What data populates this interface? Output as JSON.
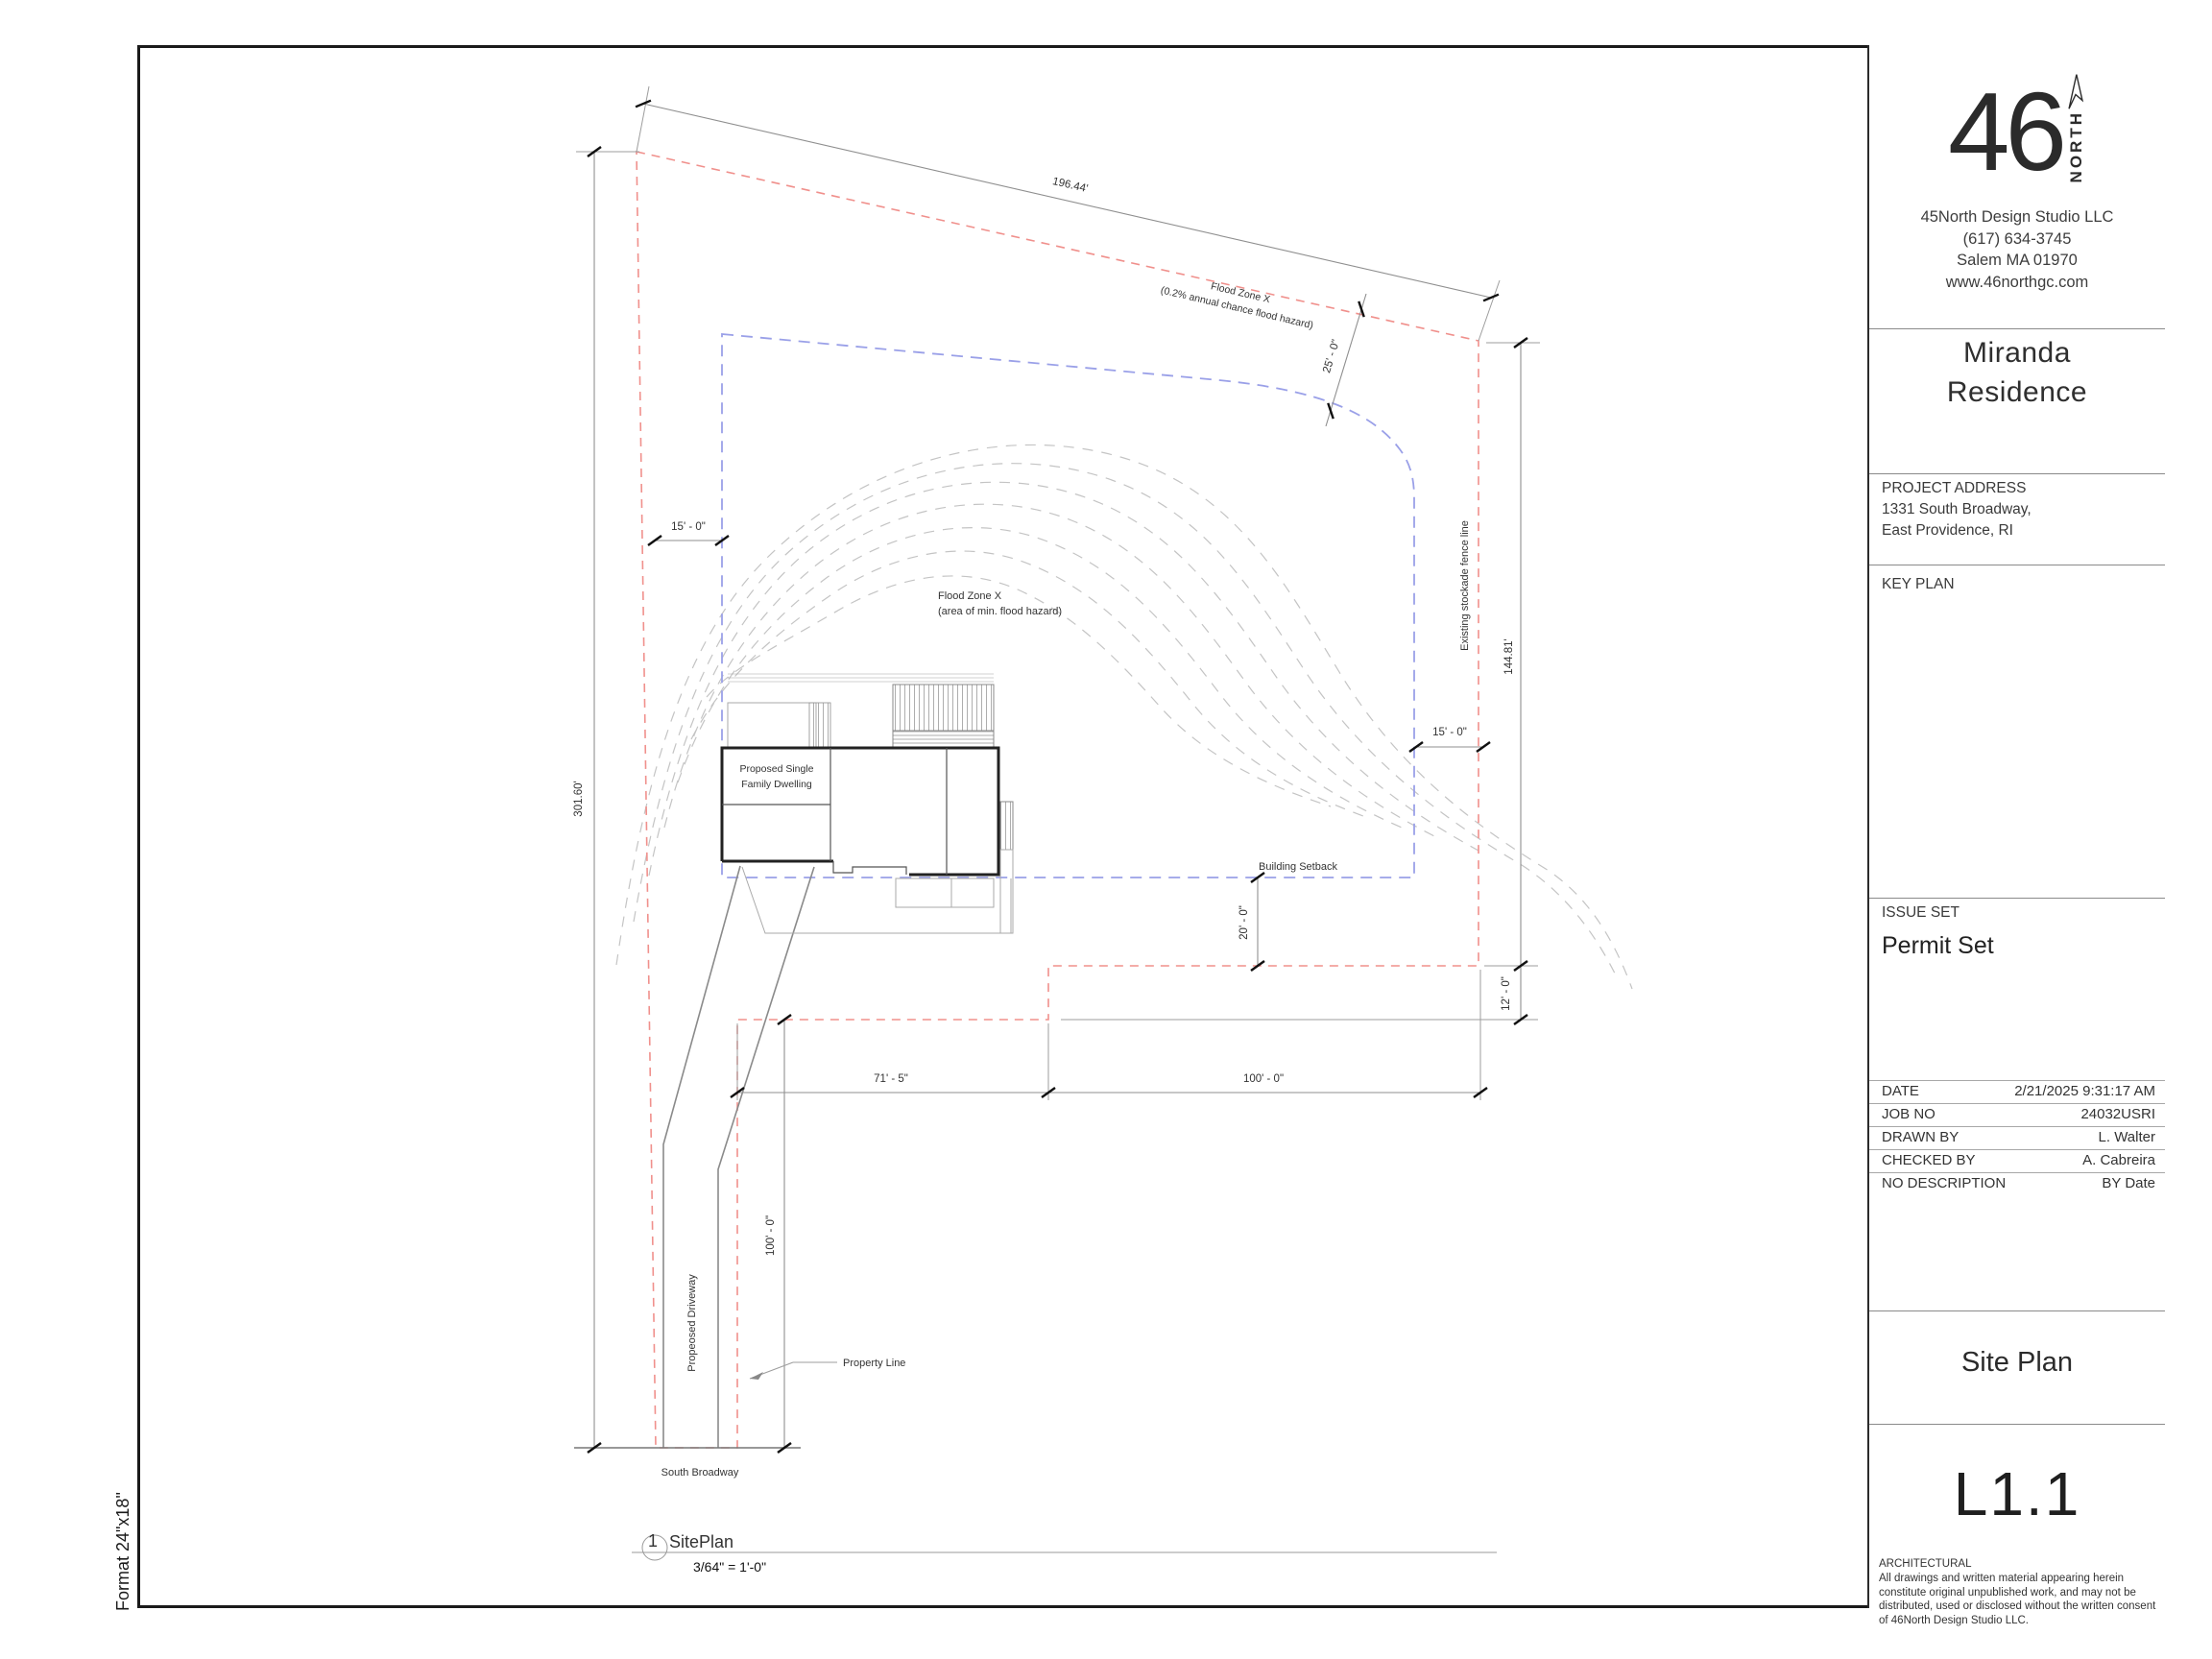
{
  "sheet": {
    "format": "Format 24\"x18\"",
    "border_color": "#1a1a1a"
  },
  "viewport_title": {
    "number": "1",
    "name": "SitePlan",
    "scale": "3/64\" = 1'-0\""
  },
  "title_block": {
    "logo": {
      "number": "46",
      "north": "NORTH"
    },
    "firm": {
      "name": "45North Design Studio LLC",
      "phone": "(617) 634-3745",
      "city": "Salem MA 01970",
      "website": "www.46northgc.com"
    },
    "project_name_1": "Miranda",
    "project_name_2": "Residence",
    "address_label": "PROJECT ADDRESS",
    "address_1": "1331 South Broadway,",
    "address_2": "East Providence, RI",
    "key_plan_label": "KEY PLAN",
    "issue_label": "ISSUE SET",
    "issue_value": "Permit Set",
    "info_rows": [
      {
        "label": "DATE",
        "value": "2/21/2025 9:31:17 AM"
      },
      {
        "label": "JOB NO",
        "value": "24032USRI"
      },
      {
        "label": "DRAWN BY",
        "value": "L. Walter"
      },
      {
        "label": "CHECKED BY",
        "value": "A. Cabreira"
      },
      {
        "label": "NO DESCRIPTION",
        "value": "BY Date"
      }
    ],
    "sheet_name": "Site Plan",
    "sheet_number": "L1.1",
    "discipline": "ARCHITECTURAL",
    "disclaimer": "All drawings and written material appearing herein constitute original unpublished work, and may not be distributed, used or disclosed without the written consent of 46North Design Studio LLC."
  },
  "plan": {
    "dims": {
      "top": "196.44'",
      "left": "301.60'",
      "right": "144.81'",
      "flood_offset": "25' - 0\"",
      "setback_left": "15' - 0\"",
      "setback_right": "15' - 0\"",
      "rear_setback": "20' - 0\"",
      "strip": "12' - 0\"",
      "front_left": "71' - 5\"",
      "front_right": "100' - 0\"",
      "driveway": "100' - 0\""
    },
    "labels": {
      "flood1_line1": "Flood Zone X",
      "flood1_line2": "(0.2% annual chance flood hazard)",
      "flood2_line1": "Flood Zone X",
      "flood2_line2": "(area of min. flood hazard)",
      "fence": "Existing stockade fence line",
      "building_setback": "Building Setback",
      "property_line": "Property Line",
      "street": "South Broadway",
      "driveway": "Propeosed Driveway",
      "dwelling_line1": "Proposed Single",
      "dwelling_line2": "Family Dwelling"
    },
    "colors": {
      "property_line": "#f0908c",
      "setback_line": "#9aa0e8",
      "contour": "#c4c4c4",
      "dimension": "#8f8f8f",
      "tick": "#111111"
    }
  }
}
